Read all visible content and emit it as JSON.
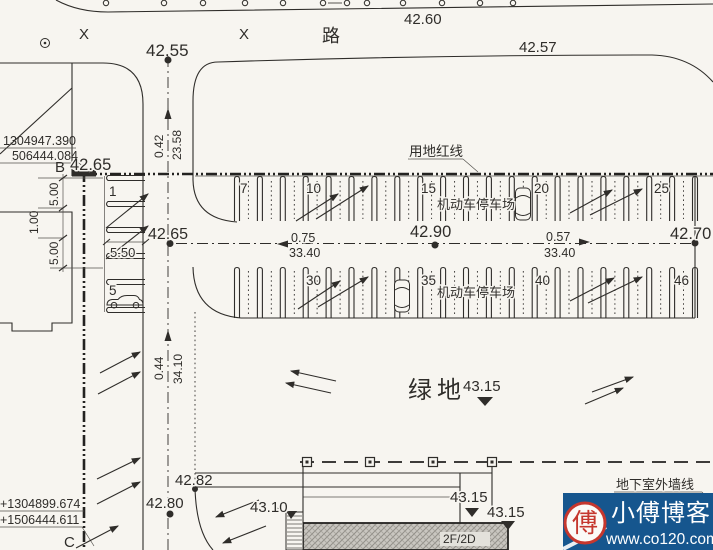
{
  "colors": {
    "paper": "#f7f5f0",
    "ink": "#2f2d2a",
    "watermark_bg": "#16568e",
    "watermark_red": "#c5372e",
    "watermark_text": "#ffffff"
  },
  "road": {
    "name": "路",
    "survey_mark": "X",
    "elev_top": "42.60",
    "elev_right": "42.57",
    "elev_center": "42.55"
  },
  "boundary": {
    "red_line_label": "用地红线",
    "basement_wall_label": "地下室外墙线"
  },
  "points": {
    "b_label": "B",
    "b_elev": "42.65",
    "b_coord_x": "1304947.390",
    "b_coord_y": "506444.084",
    "c_label": "C",
    "c_coord_x": "+1304899.674",
    "c_coord_y": "+1506444.611"
  },
  "parking": {
    "lot_label": "机动车停车场",
    "stalls": [
      "1",
      "5",
      "7",
      "10",
      "15",
      "20",
      "25",
      "30",
      "35",
      "40",
      "46"
    ]
  },
  "elevations": {
    "drive_mid": "42.65",
    "aisle_mid": "42.90",
    "aisle_east": "42.70",
    "green": "43.15",
    "south_a": "42.82",
    "south_b": "42.80",
    "south_c": "43.10",
    "bldg_a": "43.15",
    "bldg_b": "43.15"
  },
  "green": {
    "label": "绿地"
  },
  "building": {
    "floors": "2F/2D"
  },
  "dims": {
    "ns_top_grade": "0.42",
    "ns_top_len": "23.58",
    "ns_bot_grade": "0.44",
    "ns_bot_len": "34.10",
    "left_1": "5.00",
    "left_2": "1.00",
    "left_3": "5.00",
    "stall_depth": "5.50",
    "aisle_w_grade": "0.75",
    "aisle_w_len": "33.40",
    "aisle_e_grade": "0.57",
    "aisle_e_len": "33.40"
  },
  "watermark": {
    "stamp": "傅",
    "name": "小傅博客",
    "url": "www.co120.com"
  }
}
